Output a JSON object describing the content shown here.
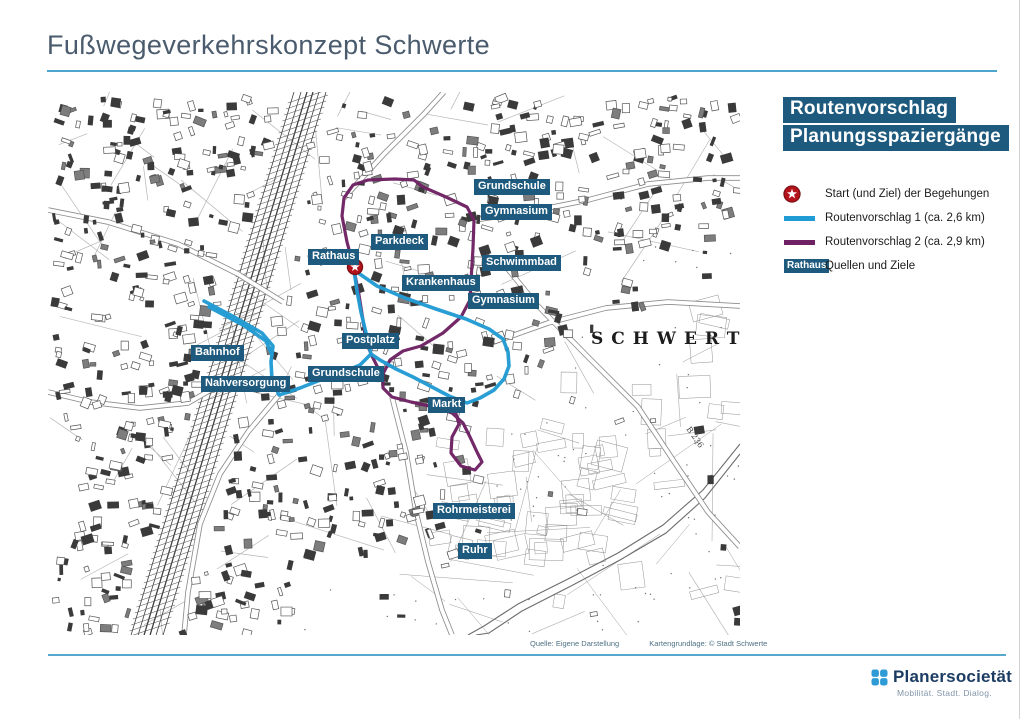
{
  "page": {
    "title": "Fußwegeverkehrskonzept Schwerte"
  },
  "colors": {
    "route1_blue": "#219bd3",
    "route2_purple": "#6e2163",
    "label_bg": "#1e5a7e",
    "rule_blue": "#4da4cc",
    "star_red": "#b5121b",
    "star_ring": "#7d1016"
  },
  "map": {
    "city_label": "SCHWERTE",
    "road_label": "B 236",
    "source_left": "Quelle: Eigene Darstellung",
    "source_right": "Kartengrundlage: © Stadt Schwerte",
    "start_marker": {
      "x": 307,
      "y": 175
    },
    "labels": [
      {
        "text": "Grundschule",
        "x": 426,
        "y": 87
      },
      {
        "text": "Gymnasium",
        "x": 433,
        "y": 112
      },
      {
        "text": "Parkdeck",
        "x": 323,
        "y": 142
      },
      {
        "text": "Rathaus",
        "x": 260,
        "y": 157
      },
      {
        "text": "Schwimmbad",
        "x": 434,
        "y": 163
      },
      {
        "text": "Krankenhaus",
        "x": 354,
        "y": 183
      },
      {
        "text": "Gymnasium",
        "x": 420,
        "y": 201
      },
      {
        "text": "Postplatz",
        "x": 294,
        "y": 241
      },
      {
        "text": "Bahnhof",
        "x": 143,
        "y": 253
      },
      {
        "text": "Nahversorgung",
        "x": 153,
        "y": 284
      },
      {
        "text": "Grundschule",
        "x": 260,
        "y": 274
      },
      {
        "text": "Markt",
        "x": 380,
        "y": 305
      },
      {
        "text": "Rohrmeisterei",
        "x": 385,
        "y": 411
      },
      {
        "text": "Ruhr",
        "x": 410,
        "y": 451
      }
    ],
    "routes": {
      "route1": {
        "width": 3.6,
        "paths": [
          [
            156,
            209,
            188,
            226,
            214,
            241,
            225,
            254,
            223,
            270,
            224,
            288,
            231,
            303,
            252,
            296,
            275,
            287,
            295,
            280,
            312,
            273,
            323,
            262,
            318,
            241,
            313,
            220,
            309,
            199,
            306,
            178,
            329,
            194,
            357,
            206,
            388,
            217,
            418,
            227,
            441,
            237,
            455,
            247,
            460,
            260,
            461,
            274,
            456,
            287,
            446,
            298,
            432,
            306,
            419,
            311,
            401,
            304,
            384,
            295,
            365,
            285,
            348,
            277,
            332,
            268,
            323,
            262
          ],
          [
            161,
            215,
            195,
            233,
            218,
            249,
            224,
            263
          ]
        ]
      },
      "route2": {
        "width": 3.2,
        "paths": [
          [
            306,
            176,
            299,
            150,
            294,
            124,
            296,
            106,
            305,
            93,
            320,
            88,
            347,
            87,
            366,
            88,
            375,
            95,
            398,
            105,
            419,
            115,
            426,
            128,
            425,
            156,
            423,
            189,
            422,
            208,
            413,
            225,
            395,
            241,
            373,
            254,
            355,
            259,
            342,
            268,
            335,
            282,
            335,
            296,
            344,
            305,
            363,
            310,
            386,
            315,
            404,
            321,
            415,
            331,
            422,
            345,
            429,
            360,
            434,
            370,
            427,
            378,
            413,
            374,
            403,
            361,
            404,
            345,
            411,
            332,
            408,
            322
          ],
          [
            306,
            178,
            311,
            203,
            315,
            228,
            318,
            250,
            324,
            264,
            331,
            278,
            335,
            288
          ]
        ]
      }
    }
  },
  "legend": {
    "title_line1": "Routenvorschlag",
    "title_line2": "Planungsspaziergänge",
    "items": [
      {
        "type": "star",
        "label": "Start (und Ziel) der Begehungen"
      },
      {
        "type": "line",
        "color": "#219bd3",
        "label": "Routenvorschlag 1 (ca. 2,6 km)"
      },
      {
        "type": "line",
        "color": "#6e2163",
        "label": "Routenvorschlag 2 (ca. 2,9 km)"
      },
      {
        "type": "tag",
        "tag_text": "Rathaus",
        "label": "Quellen und Ziele"
      }
    ]
  },
  "footer": {
    "logo_text": "Planersocietät",
    "logo_tagline": "Mobilität. Stadt. Dialog."
  }
}
